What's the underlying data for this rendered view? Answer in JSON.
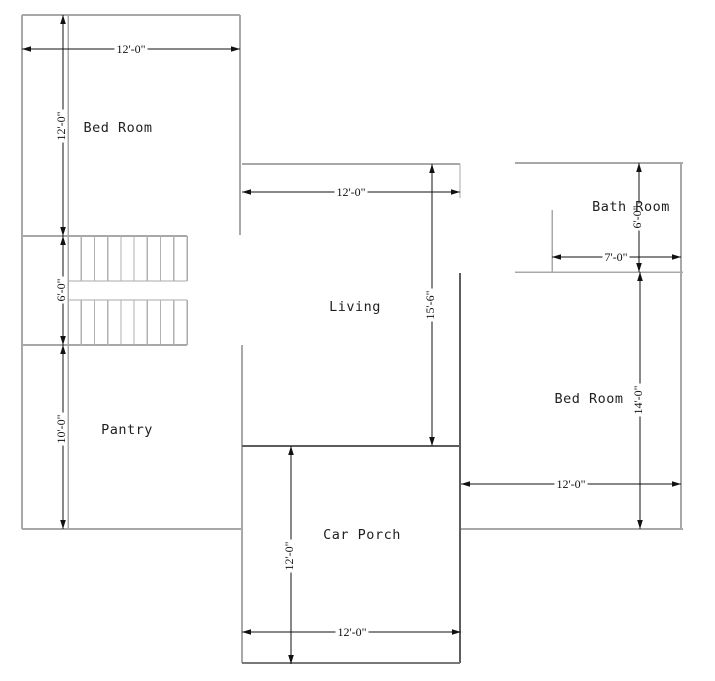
{
  "plan": {
    "width": 715,
    "height": 681,
    "colors": {
      "background": "#ffffff",
      "wall": "#a8a8a8",
      "wall_mid": "#787878",
      "wall_dark": "#5d5d5d",
      "stair_tread": "#b2b2b2",
      "dimension": "#111111",
      "room_label": "#1f1f1f"
    },
    "rooms": [
      {
        "id": "bedroom-left",
        "label": "Bed Room",
        "x": 118,
        "y": 128
      },
      {
        "id": "living",
        "label": "Living",
        "x": 355,
        "y": 307
      },
      {
        "id": "pantry",
        "label": "Pantry",
        "x": 127,
        "y": 430
      },
      {
        "id": "car-porch",
        "label": "Car Porch",
        "x": 362,
        "y": 535
      },
      {
        "id": "bath-room",
        "label": "Bath Room",
        "x": 631,
        "y": 207
      },
      {
        "id": "bedroom-right",
        "label": "Bed Room",
        "x": 589,
        "y": 399
      }
    ],
    "walls": [
      {
        "x1": 22,
        "y1": 15,
        "x2": 240,
        "y2": 15,
        "w": 2,
        "tone": "wall"
      },
      {
        "x1": 22,
        "y1": 15,
        "x2": 22,
        "y2": 529,
        "w": 2,
        "tone": "wall"
      },
      {
        "x1": 68,
        "y1": 15,
        "x2": 68,
        "y2": 529,
        "w": 1.5,
        "tone": "wall"
      },
      {
        "x1": 240,
        "y1": 15,
        "x2": 240,
        "y2": 235,
        "w": 2,
        "tone": "wall"
      },
      {
        "x1": 22,
        "y1": 236,
        "x2": 187,
        "y2": 236,
        "w": 2,
        "tone": "wall"
      },
      {
        "x1": 68,
        "y1": 281,
        "x2": 187,
        "y2": 281,
        "w": 1.2,
        "tone": "wall"
      },
      {
        "x1": 68,
        "y1": 300,
        "x2": 187,
        "y2": 300,
        "w": 1.2,
        "tone": "wall"
      },
      {
        "x1": 187,
        "y1": 236,
        "x2": 187,
        "y2": 281,
        "w": 1.5,
        "tone": "wall"
      },
      {
        "x1": 187,
        "y1": 300,
        "x2": 187,
        "y2": 345,
        "w": 1.5,
        "tone": "wall"
      },
      {
        "x1": 22,
        "y1": 345,
        "x2": 187,
        "y2": 345,
        "w": 2,
        "tone": "wall"
      },
      {
        "x1": 22,
        "y1": 529,
        "x2": 242,
        "y2": 529,
        "w": 2,
        "tone": "wall"
      },
      {
        "x1": 242,
        "y1": 345,
        "x2": 242,
        "y2": 663,
        "w": 2,
        "tone": "wall"
      },
      {
        "x1": 242,
        "y1": 164,
        "x2": 460,
        "y2": 164,
        "w": 2,
        "tone": "wall"
      },
      {
        "x1": 242,
        "y1": 446,
        "x2": 461,
        "y2": 446,
        "w": 2,
        "tone": "wall_dark"
      },
      {
        "x1": 460,
        "y1": 273,
        "x2": 460,
        "y2": 663,
        "w": 2,
        "tone": "wall_dark"
      },
      {
        "x1": 242,
        "y1": 663,
        "x2": 460,
        "y2": 663,
        "w": 2,
        "tone": "wall_mid"
      },
      {
        "x1": 515,
        "y1": 163,
        "x2": 683,
        "y2": 163,
        "w": 2,
        "tone": "wall"
      },
      {
        "x1": 681,
        "y1": 163,
        "x2": 681,
        "y2": 529,
        "w": 2,
        "tone": "wall"
      },
      {
        "x1": 515,
        "y1": 272,
        "x2": 683,
        "y2": 272,
        "w": 1.5,
        "tone": "wall"
      },
      {
        "x1": 552,
        "y1": 210,
        "x2": 552,
        "y2": 272,
        "w": 1.5,
        "tone": "wall"
      },
      {
        "x1": 461,
        "y1": 529,
        "x2": 683,
        "y2": 529,
        "w": 2,
        "tone": "wall"
      },
      {
        "x1": 460,
        "y1": 164,
        "x2": 460,
        "y2": 198,
        "w": 1,
        "tone": "wall"
      }
    ],
    "stairs": {
      "left": 68,
      "right": 187,
      "treads_per_flight": 8,
      "flights": [
        {
          "top": 236,
          "bottom": 281
        },
        {
          "top": 300,
          "bottom": 345
        }
      ]
    },
    "dimensions": [
      {
        "label": "12'-0\"",
        "dir": "h",
        "x1": 22,
        "x2": 240,
        "y": 49,
        "lx": 131,
        "ly": 49
      },
      {
        "label": "12'-0\"",
        "dir": "v",
        "y1": 15,
        "y2": 236,
        "x": 63,
        "lx": 61,
        "ly": 126
      },
      {
        "label": "6'-0\"",
        "dir": "v",
        "y1": 236,
        "y2": 345,
        "x": 63,
        "lx": 61,
        "ly": 290
      },
      {
        "label": "10'-0\"",
        "dir": "v",
        "y1": 345,
        "y2": 529,
        "x": 63,
        "lx": 61,
        "ly": 429
      },
      {
        "label": "12'-0\"",
        "dir": "h",
        "x1": 242,
        "x2": 460,
        "y": 192,
        "lx": 351,
        "ly": 192
      },
      {
        "label": "15'-6\"",
        "dir": "v",
        "y1": 164,
        "y2": 446,
        "x": 432,
        "lx": 430,
        "ly": 305
      },
      {
        "label": "6'-0\"",
        "dir": "v",
        "y1": 163,
        "y2": 272,
        "x": 639,
        "lx": 637,
        "ly": 217
      },
      {
        "label": "7'-0\"",
        "dir": "h",
        "x1": 552,
        "x2": 681,
        "y": 257,
        "lx": 616,
        "ly": 257
      },
      {
        "label": "14'-0\"",
        "dir": "v",
        "y1": 272,
        "y2": 529,
        "x": 640,
        "lx": 638,
        "ly": 400
      },
      {
        "label": "12'-0\"",
        "dir": "h",
        "x1": 461,
        "x2": 681,
        "y": 484,
        "lx": 571,
        "ly": 484
      },
      {
        "label": "12'-0\"",
        "dir": "v",
        "y1": 446,
        "y2": 664,
        "x": 291,
        "lx": 289,
        "ly": 556
      },
      {
        "label": "12'-0\"",
        "dir": "h",
        "x1": 242,
        "x2": 461,
        "y": 632,
        "lx": 352,
        "ly": 632
      }
    ]
  }
}
